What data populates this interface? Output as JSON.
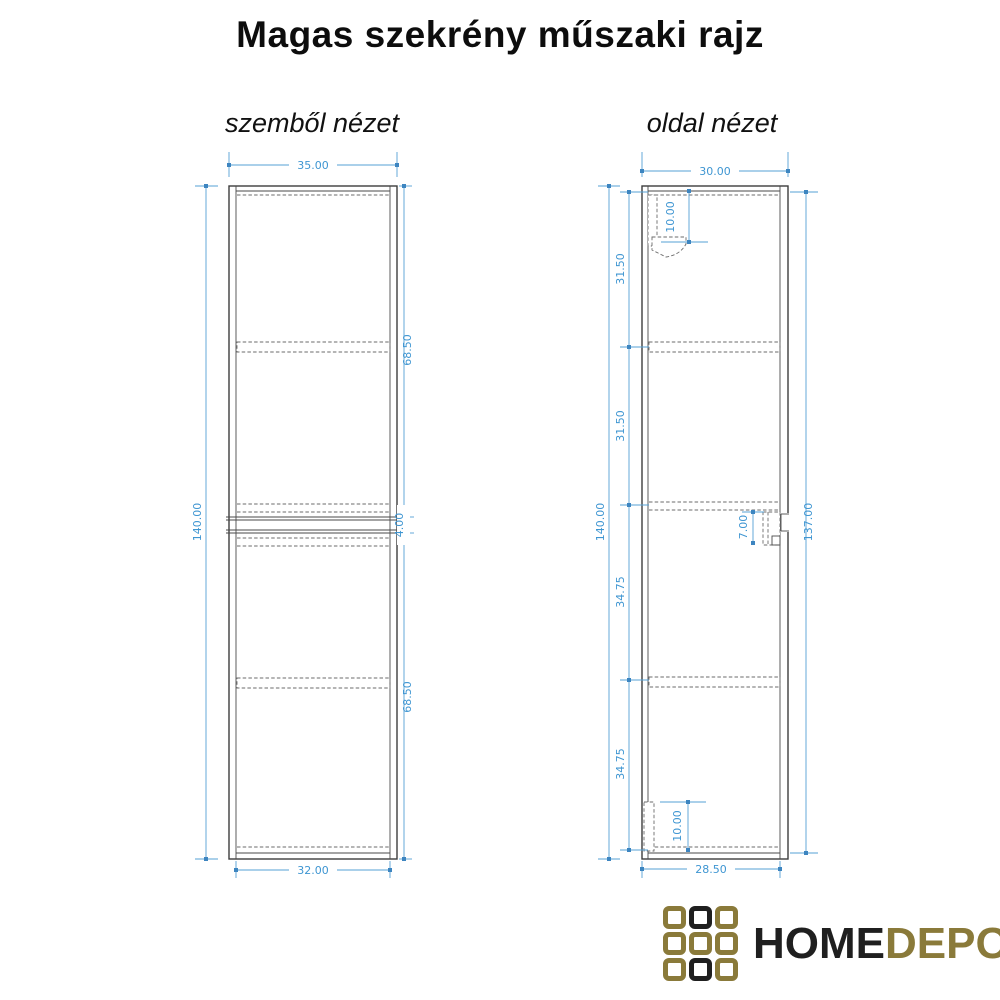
{
  "title": "Magas szekrény műszaki rajz",
  "views": {
    "front_label": "szemből nézet",
    "side_label": "oldal nézet"
  },
  "front": {
    "dims": {
      "top_width": "35.00",
      "height": "140.00",
      "upper_section": "68.50",
      "middle_gap": "4.00",
      "lower_section": "68.50",
      "bottom_width": "32.00"
    }
  },
  "side": {
    "dims": {
      "top_width": "30.00",
      "height": "140.00",
      "right_height": "137.00",
      "segment_1": "31.50",
      "segment_2": "31.50",
      "segment_3": "34.75",
      "segment_4": "34.75",
      "top_bracket_offset": "10.00",
      "handle_offset": "7.00",
      "bottom_plinth_height": "10.00",
      "bottom_width": "28.50"
    }
  },
  "logo": {
    "text_primary": "HOME",
    "text_secondary": "DEPO",
    "colors": {
      "gold": "#8a7a3a",
      "black": "#1f1f1f"
    },
    "grid_pattern": [
      [
        "gold",
        "black",
        "gold"
      ],
      [
        "gold",
        "gold",
        "gold"
      ],
      [
        "gold",
        "black",
        "gold"
      ]
    ]
  },
  "colors": {
    "dimension_blue": "#3f96d2",
    "drawing_line": "#3d3d3d",
    "background": "#ffffff"
  }
}
